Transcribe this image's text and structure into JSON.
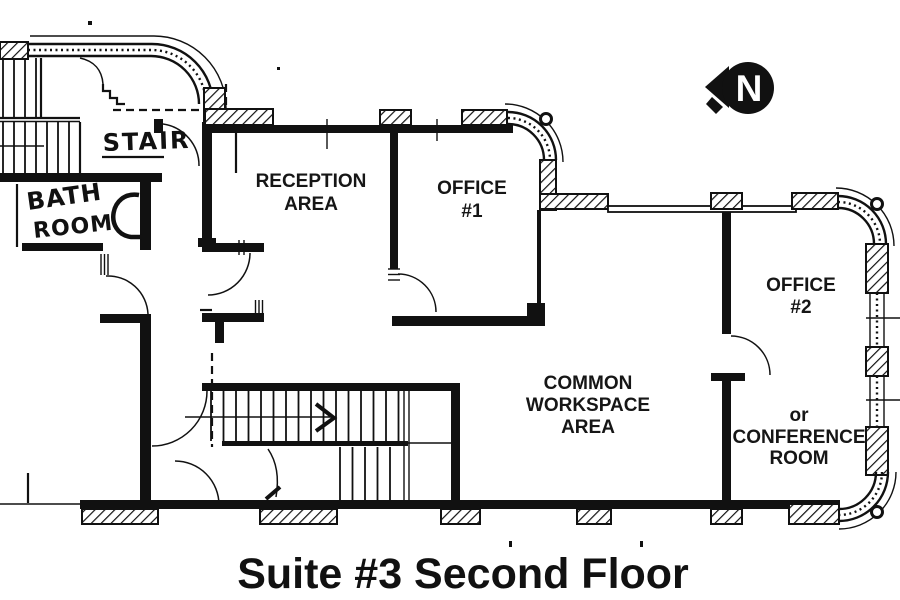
{
  "title": "Suite #3 Second Floor",
  "north_indicator": {
    "letter": "N"
  },
  "rooms": {
    "stair": {
      "label": "STAIR"
    },
    "bathroom": {
      "lines": [
        "BATH",
        "ROOM"
      ]
    },
    "reception": {
      "lines": [
        "RECEPTION",
        "AREA"
      ]
    },
    "office1": {
      "lines": [
        "OFFICE",
        "#1"
      ]
    },
    "common": {
      "lines": [
        "COMMON",
        "WORKSPACE",
        "AREA"
      ]
    },
    "office2": {
      "lines": [
        "OFFICE",
        "#2"
      ]
    },
    "conference": {
      "lines": [
        "or",
        "CONFERENCE",
        "ROOM"
      ]
    }
  },
  "colors": {
    "ink": "#111111",
    "paper": "#ffffff"
  }
}
